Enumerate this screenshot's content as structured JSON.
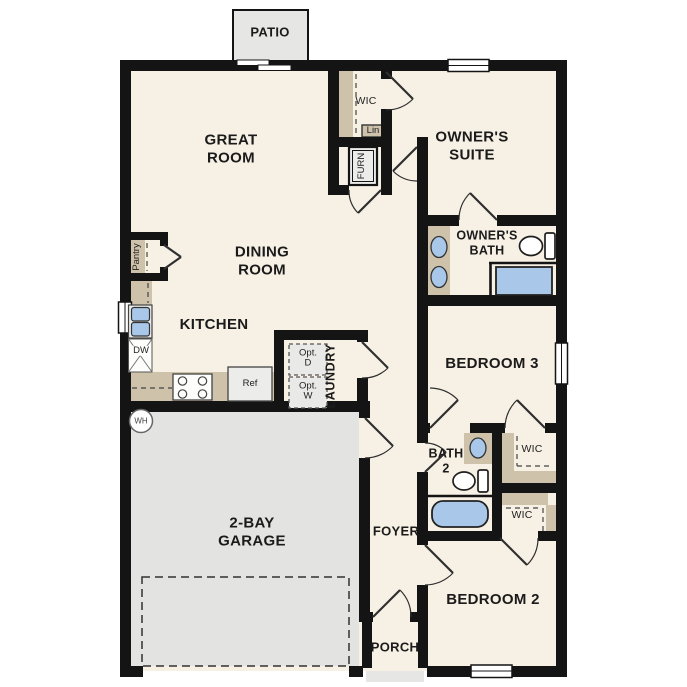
{
  "plan": {
    "title": "single-story-floor-plan",
    "colors": {
      "wall": "#141414",
      "floor": "#f7f1e5",
      "garage": "#e3e3e1",
      "patio": "#e6e6e4",
      "casework_tan": "#cec2aa",
      "fixture_blue": "#a9c7e9",
      "appliance_gray": "#ececea"
    },
    "labels": {
      "patio": "PATIO",
      "great_room": "GREAT\nROOM",
      "wic_owner": "WIC",
      "lin": "Lin",
      "furn": "FURN",
      "owners_suite": "OWNER'S\nSUITE",
      "owners_bath": "OWNER'S\nBATH",
      "dining_room": "DINING\nROOM",
      "pantry": "Pantry",
      "kitchen": "KITCHEN",
      "dw": "DW",
      "ref": "Ref",
      "opt_d": "Opt.\nD",
      "opt_w": "Opt.\nW",
      "laundry": "LAUNDRY",
      "bedroom3": "BEDROOM 3",
      "wh": "WH",
      "bath2": "BATH\n2",
      "wic_bedroom3": "WIC",
      "wic_bedroom2": "WIC",
      "garage": "2-BAY\nGARAGE",
      "foyer": "FOYER",
      "bedroom2": "BEDROOM 2",
      "porch": "PORCH"
    }
  }
}
